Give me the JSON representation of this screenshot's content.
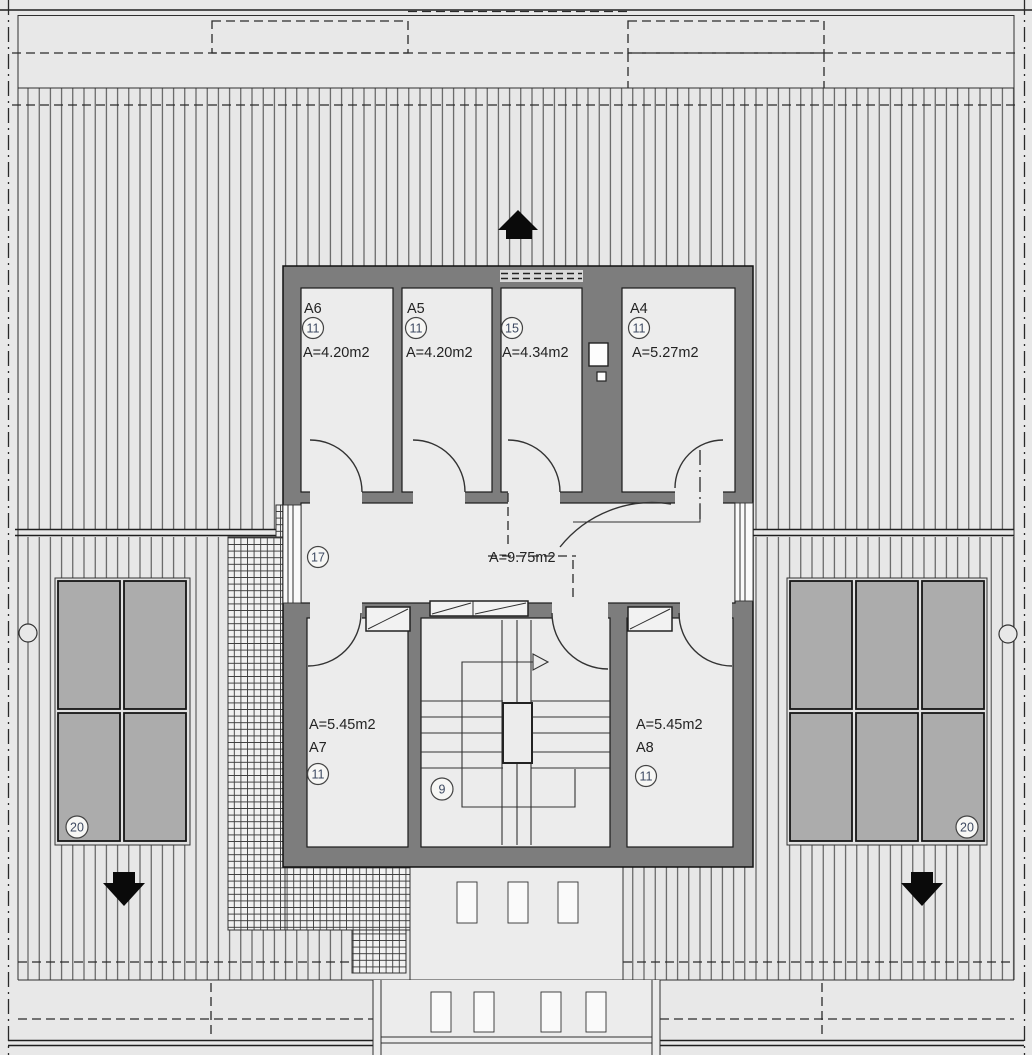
{
  "plan": {
    "rooms": [
      {
        "name": "A6",
        "tag": "11",
        "area": "A=4.20m2"
      },
      {
        "name": "A5",
        "tag": "11",
        "area": "A=4.20m2"
      },
      {
        "name": "",
        "tag": "15",
        "area": "A=4.34m2"
      },
      {
        "name": "A4",
        "tag": "11",
        "area": "A=5.27m2"
      },
      {
        "name": "A7",
        "tag": "11",
        "area": "A=5.45m2"
      },
      {
        "name": "A8",
        "tag": "11",
        "area": "A=5.45m2"
      }
    ],
    "hall": {
      "tag": "17",
      "area": "A=9.75m2"
    },
    "stair": {
      "tag": "9"
    },
    "roof_windows": {
      "left_tag": "20",
      "right_tag": "20",
      "left_count": 4,
      "right_count": 6
    },
    "colors": {
      "bg": "#e8e8e8",
      "roof": "#e7e7e7",
      "room": "#ececec",
      "wall": "#7d7d7d",
      "panel": "#acacac",
      "tag": "#3e4a62",
      "label": "#232323"
    }
  }
}
